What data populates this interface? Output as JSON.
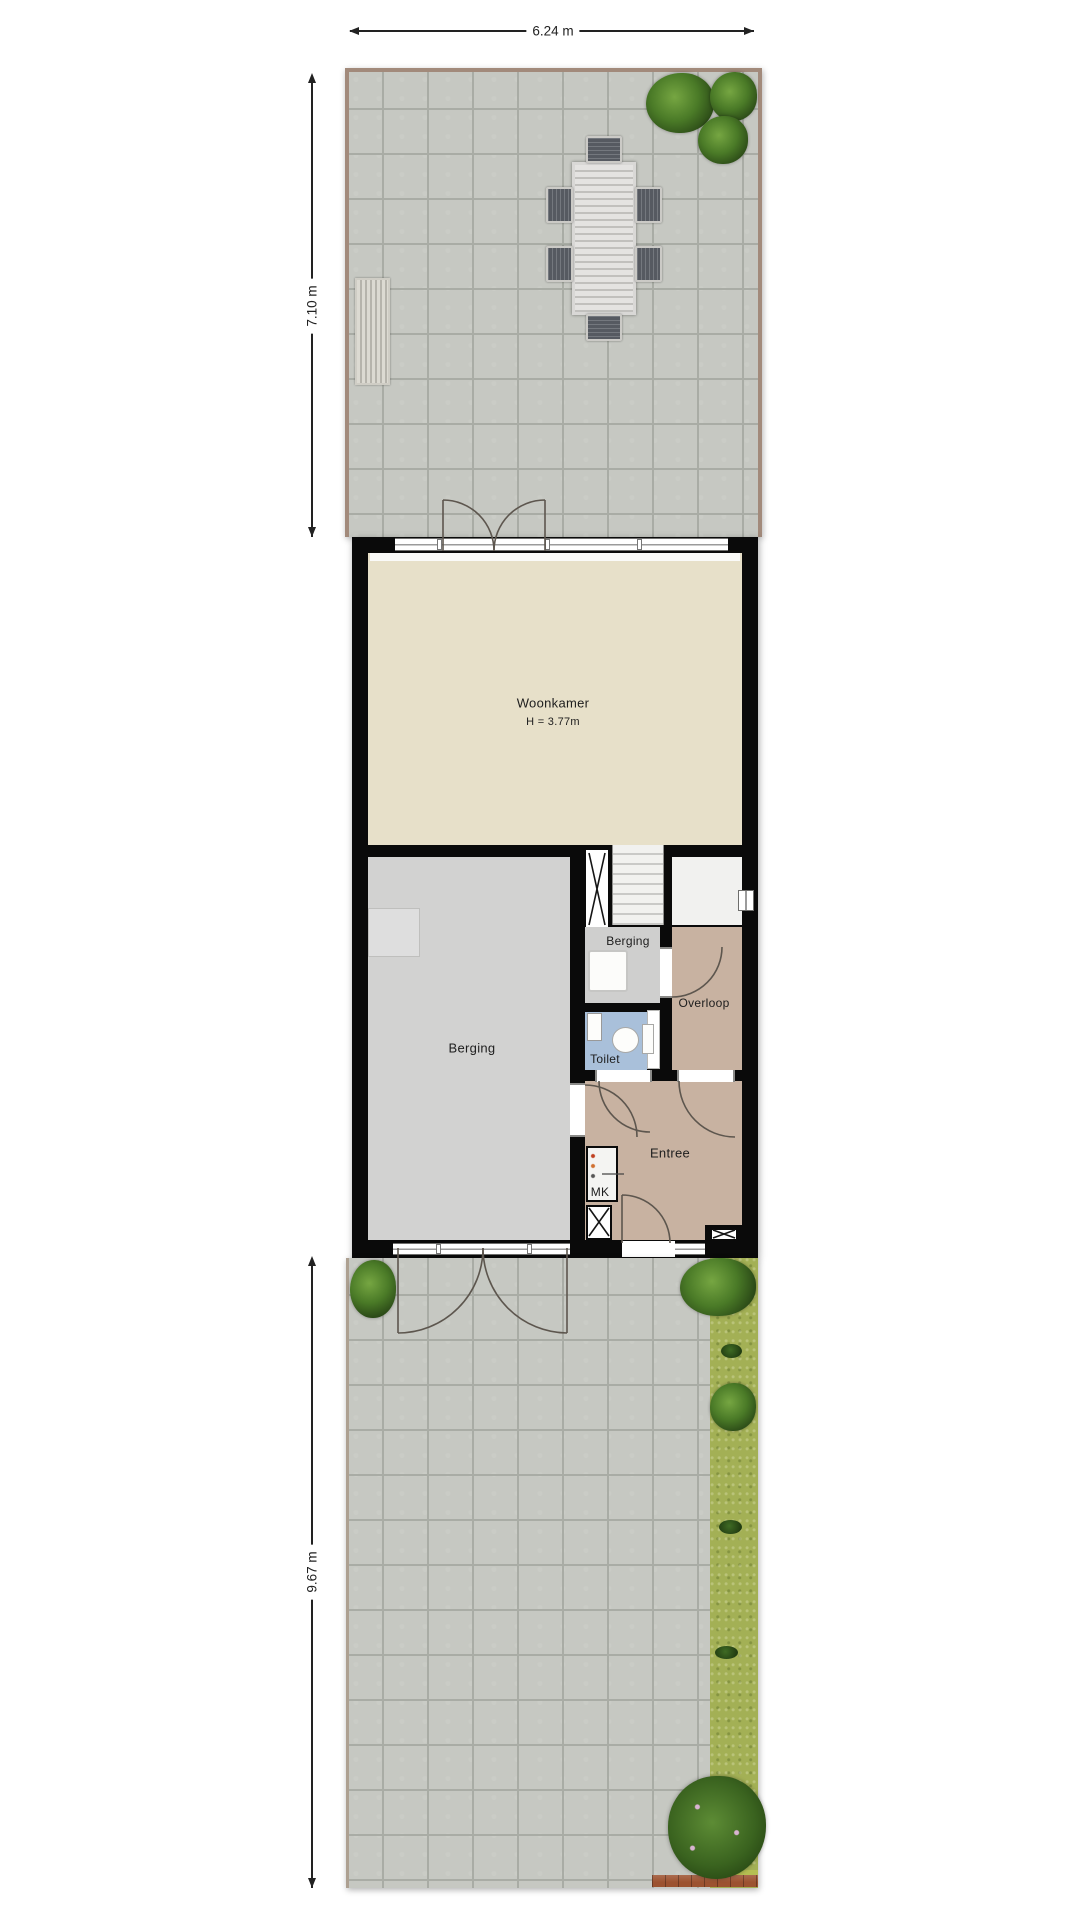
{
  "plan": {
    "dimensions": {
      "width_top": "6.24 m",
      "depth_upper_garden": "7.10 m",
      "depth_lower_garden": "9.67 m"
    },
    "rooms": {
      "woonkamer": {
        "label": "Woonkamer",
        "height": "H = 3.77m"
      },
      "berging_large": {
        "label": "Berging"
      },
      "berging_small": {
        "label": "Berging"
      },
      "overloop": {
        "label": "Overloop"
      },
      "toilet": {
        "label": "Toilet"
      },
      "entree": {
        "label": "Entree"
      },
      "meterkast": {
        "label": "MK"
      }
    },
    "colors": {
      "woonkamer_floor": "#e7e0c9",
      "berging_floor": "#d2d2d1",
      "hall_floor": "#c8b2a1",
      "toilet_floor": "#a9c0da",
      "wall": "#0a0a0a",
      "paving": "#c6c8c2",
      "grass": "#a3b055",
      "fence": "#a28a7b"
    }
  }
}
